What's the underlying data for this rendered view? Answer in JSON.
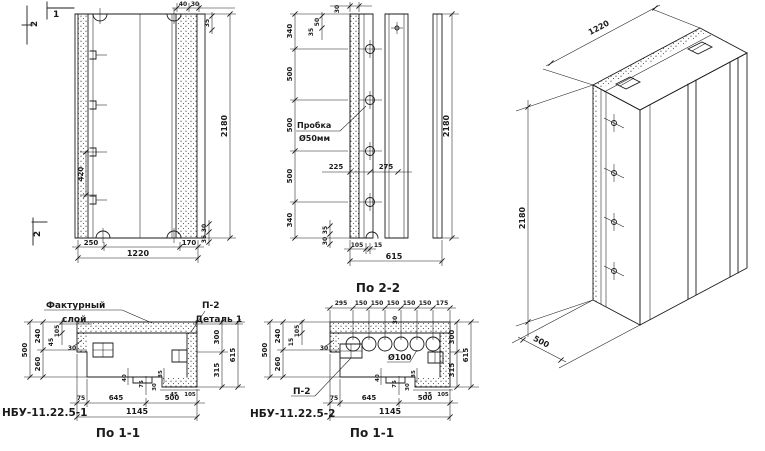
{
  "elevation": {
    "section_top_2": "2",
    "section_top_1": "1",
    "section_bottom_2": "2",
    "top_40": "40",
    "top_30": "30",
    "top_35": "35",
    "tie_420": "420",
    "height_2180": "2180",
    "corner_30": "30",
    "corner_35": "35",
    "bottom_250": "250",
    "bottom_170": "170",
    "bottom_1220": "1220"
  },
  "section22": {
    "top_30": "30",
    "top_50": "50",
    "top_35": "35",
    "left_dims": [
      "340",
      "500",
      "500",
      "500",
      "340"
    ],
    "plug_line1": "Пробка",
    "plug_line2": "Ø50мм",
    "hole_225": "225",
    "hole_275": "275",
    "height_2180": "2180",
    "corner_35": "35",
    "corner_30": "30",
    "bottom_105": "105",
    "bottom_15": "15",
    "bottom_615": "615",
    "label": "По 2-2"
  },
  "plan1": {
    "facing_line1": "Фактурный",
    "facing_line2": "слой",
    "detail_ref": "П-2",
    "detail_label": "Деталь 1",
    "left_500": "500",
    "left_240": "240",
    "left_260": "260",
    "left_105": "105",
    "left_45": "45",
    "left_30": "30",
    "right_300": "300",
    "right_615": "615",
    "right_315": "315",
    "step_40": "40",
    "step_75": "75",
    "step_30": "30",
    "step_35": "35",
    "step_45": "45",
    "step_105": "105",
    "bottom_75": "75",
    "bottom_645": "645",
    "bottom_500": "500",
    "bottom_1145": "1145",
    "mark": "НБУ-11.22.5-1",
    "label": "По 1-1"
  },
  "plan2": {
    "top_dims": [
      "295",
      "150",
      "150",
      "150",
      "150",
      "150",
      "175"
    ],
    "web_30": "30",
    "left_500": "500",
    "left_240": "240",
    "left_260": "260",
    "left_105": "105",
    "left_15": "15",
    "left_30": "30",
    "right_300": "300",
    "right_615": "615",
    "right_315": "315",
    "hole_label": "Ø100",
    "detail_ref": "П-2",
    "step_40": "40",
    "step_75": "75",
    "step_35": "35",
    "step_30": "30",
    "step_15": "15",
    "step_105": "105",
    "bottom_75": "75",
    "bottom_645": "645",
    "bottom_500": "500",
    "bottom_1145": "1145",
    "mark": "НБУ-11.22.5-2",
    "label": "По 1-1"
  },
  "isometric": {
    "width_1220": "1220",
    "height_2180": "2180",
    "depth_500": "500"
  },
  "colors": {
    "ink": "#1b1b1b",
    "paper": "#ffffff"
  }
}
